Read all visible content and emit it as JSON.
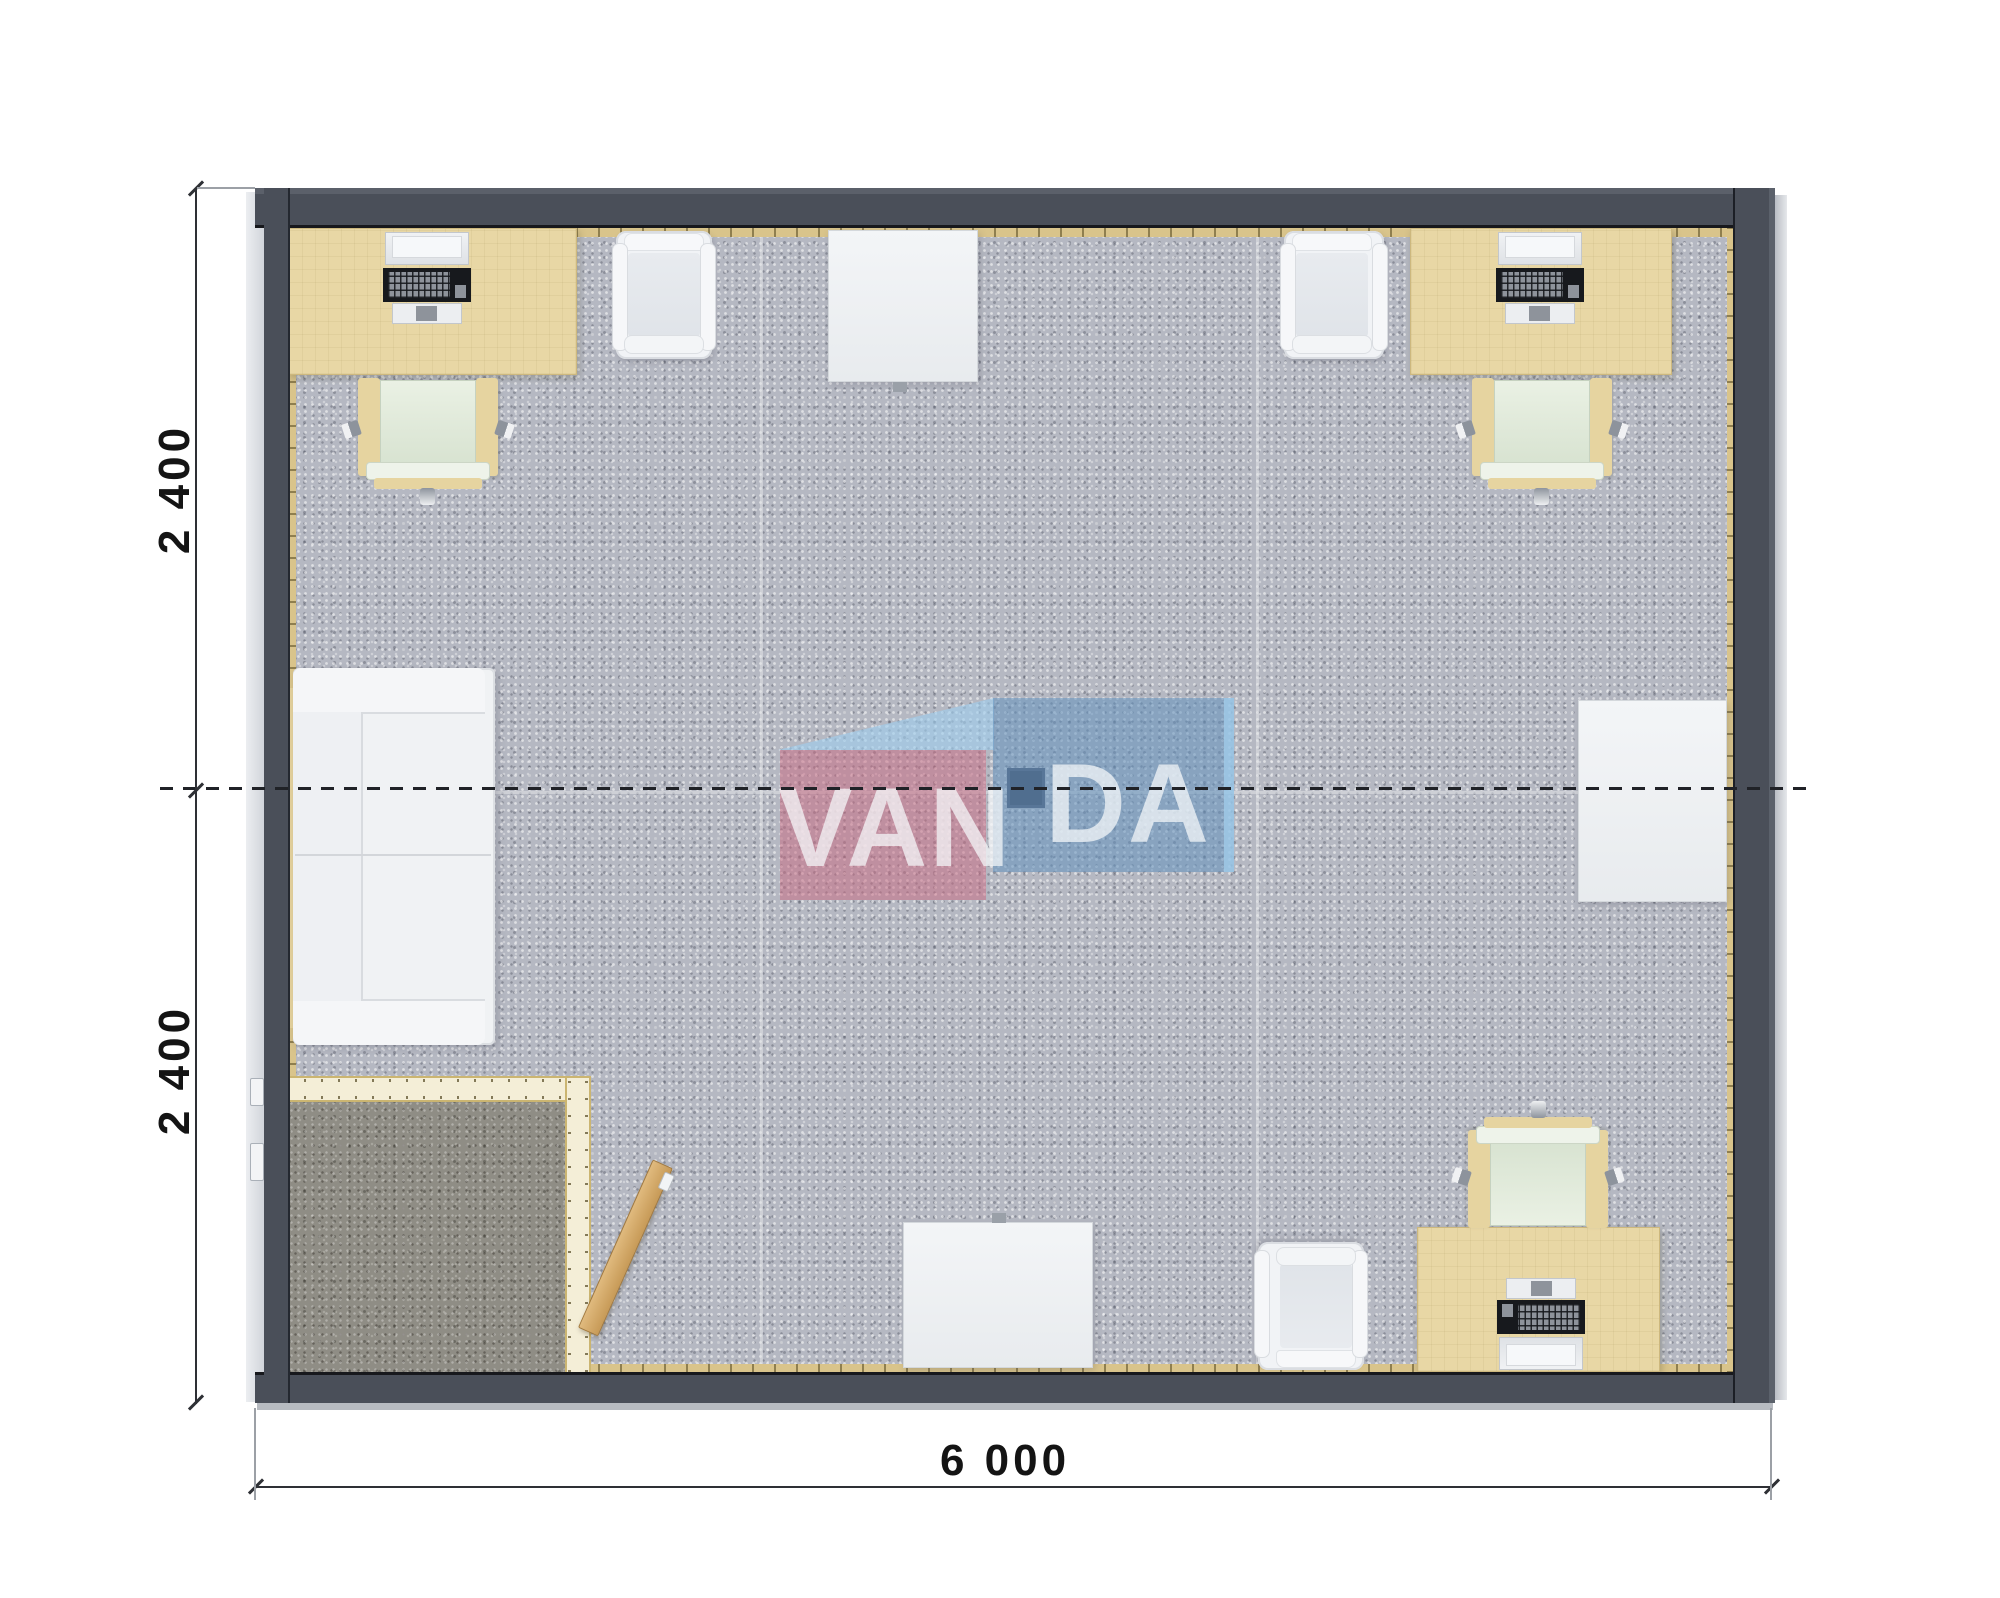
{
  "watermark": {
    "brand": "VANDA",
    "left_letters": "VAN",
    "right_letters": "DA",
    "pink_color": "#c96980",
    "blue_color": "#6292be",
    "light_blue_color": "#9ecdee"
  },
  "dimensions": {
    "left_top": "2 400",
    "left_bottom": "2 400",
    "bottom": "6 000",
    "implied_unit": "mm",
    "building_width_mm": 6000,
    "building_depth_mm": 4800
  },
  "palette": {
    "wall": "#4a4f59",
    "carpet": "#b5b8c2",
    "carpet_dark_room": "#8f8d85",
    "desk_wood": "#e8d7a5",
    "partition_wall": "#f4eed7",
    "door_wood": "#cf9f5e",
    "floor_box_navy": "#3a4457"
  },
  "furniture": [
    {
      "name": "desk-with-computer",
      "count": 3
    },
    {
      "name": "office-chair",
      "count": 3
    },
    {
      "name": "lounge-armchair",
      "count": 3
    },
    {
      "name": "white-side-table",
      "count": 3
    },
    {
      "name": "sofa",
      "count": 1
    },
    {
      "name": "storage-room-with-open-door",
      "count": 1
    },
    {
      "name": "floor-service-box",
      "count": 1
    }
  ]
}
